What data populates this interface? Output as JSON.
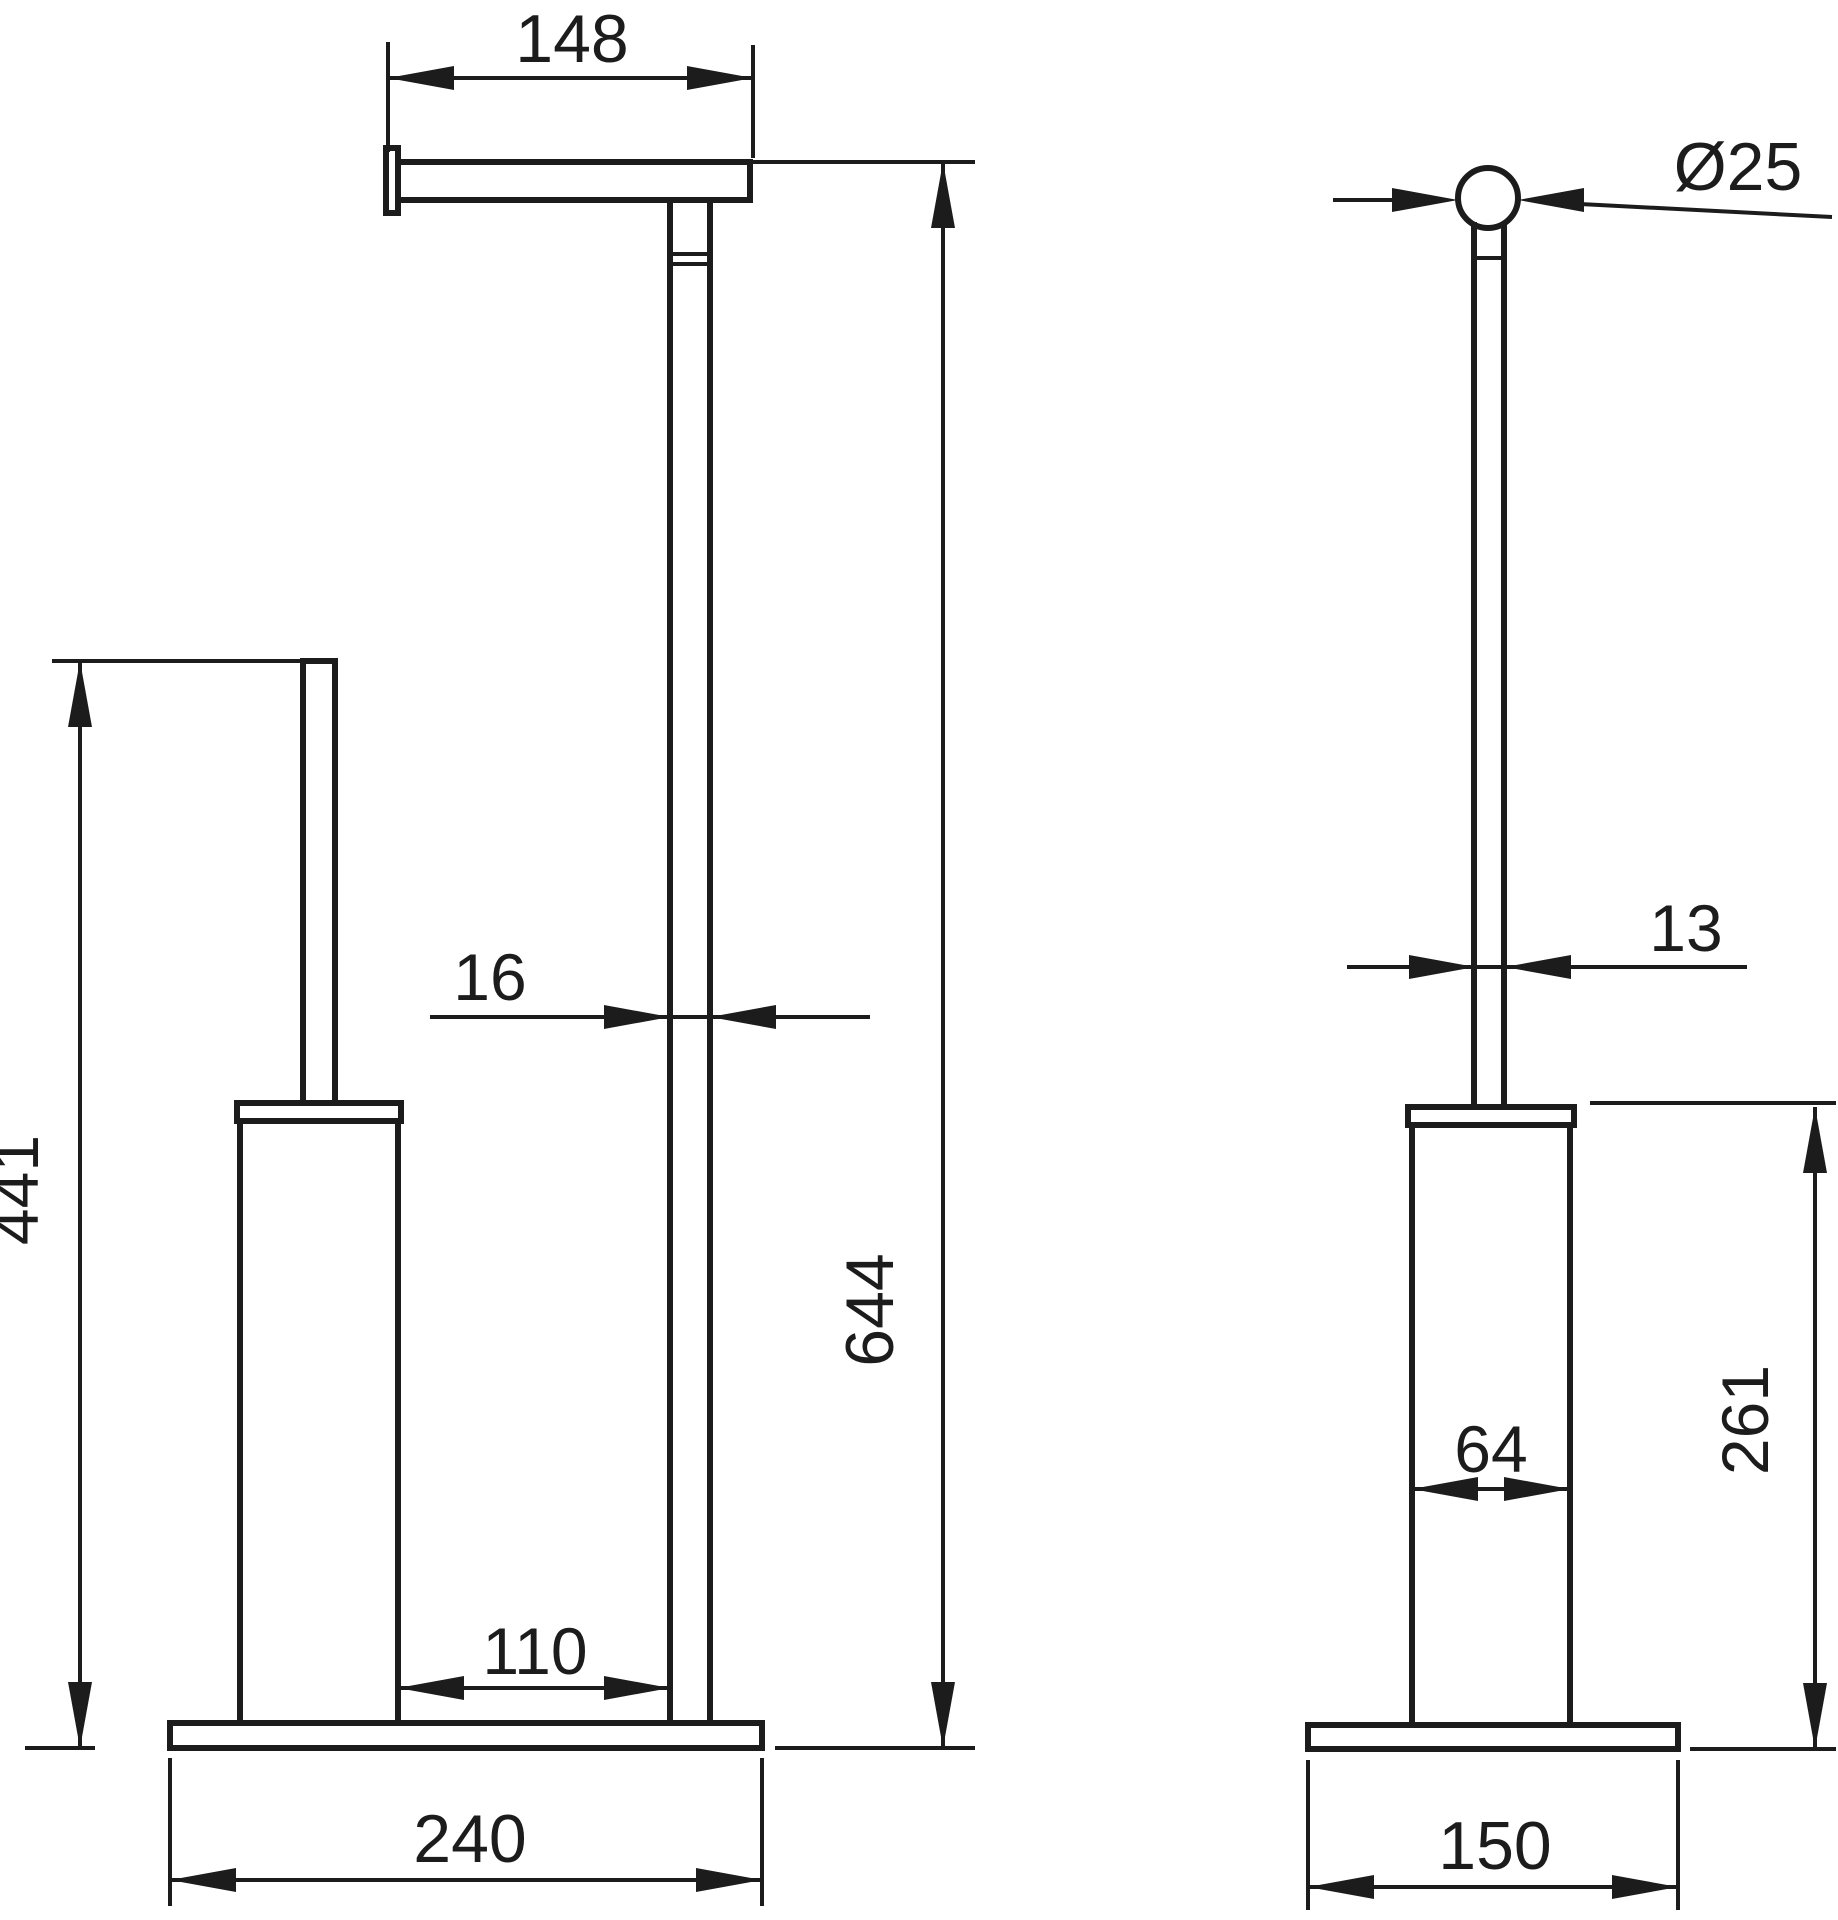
{
  "colors": {
    "line": "#1c1c1c",
    "background": "#ffffff"
  },
  "front_view": {
    "dim_arm_width": "148",
    "dim_stem_width": "16",
    "dim_total_height": "644",
    "dim_brush_height": "441",
    "dim_cup_to_stem": "110",
    "dim_base_width": "240"
  },
  "side_view": {
    "dim_knob_diameter": "Ø25",
    "dim_rod_width": "13",
    "dim_cup_width": "64",
    "dim_cup_height": "261",
    "dim_base_depth": "150"
  }
}
